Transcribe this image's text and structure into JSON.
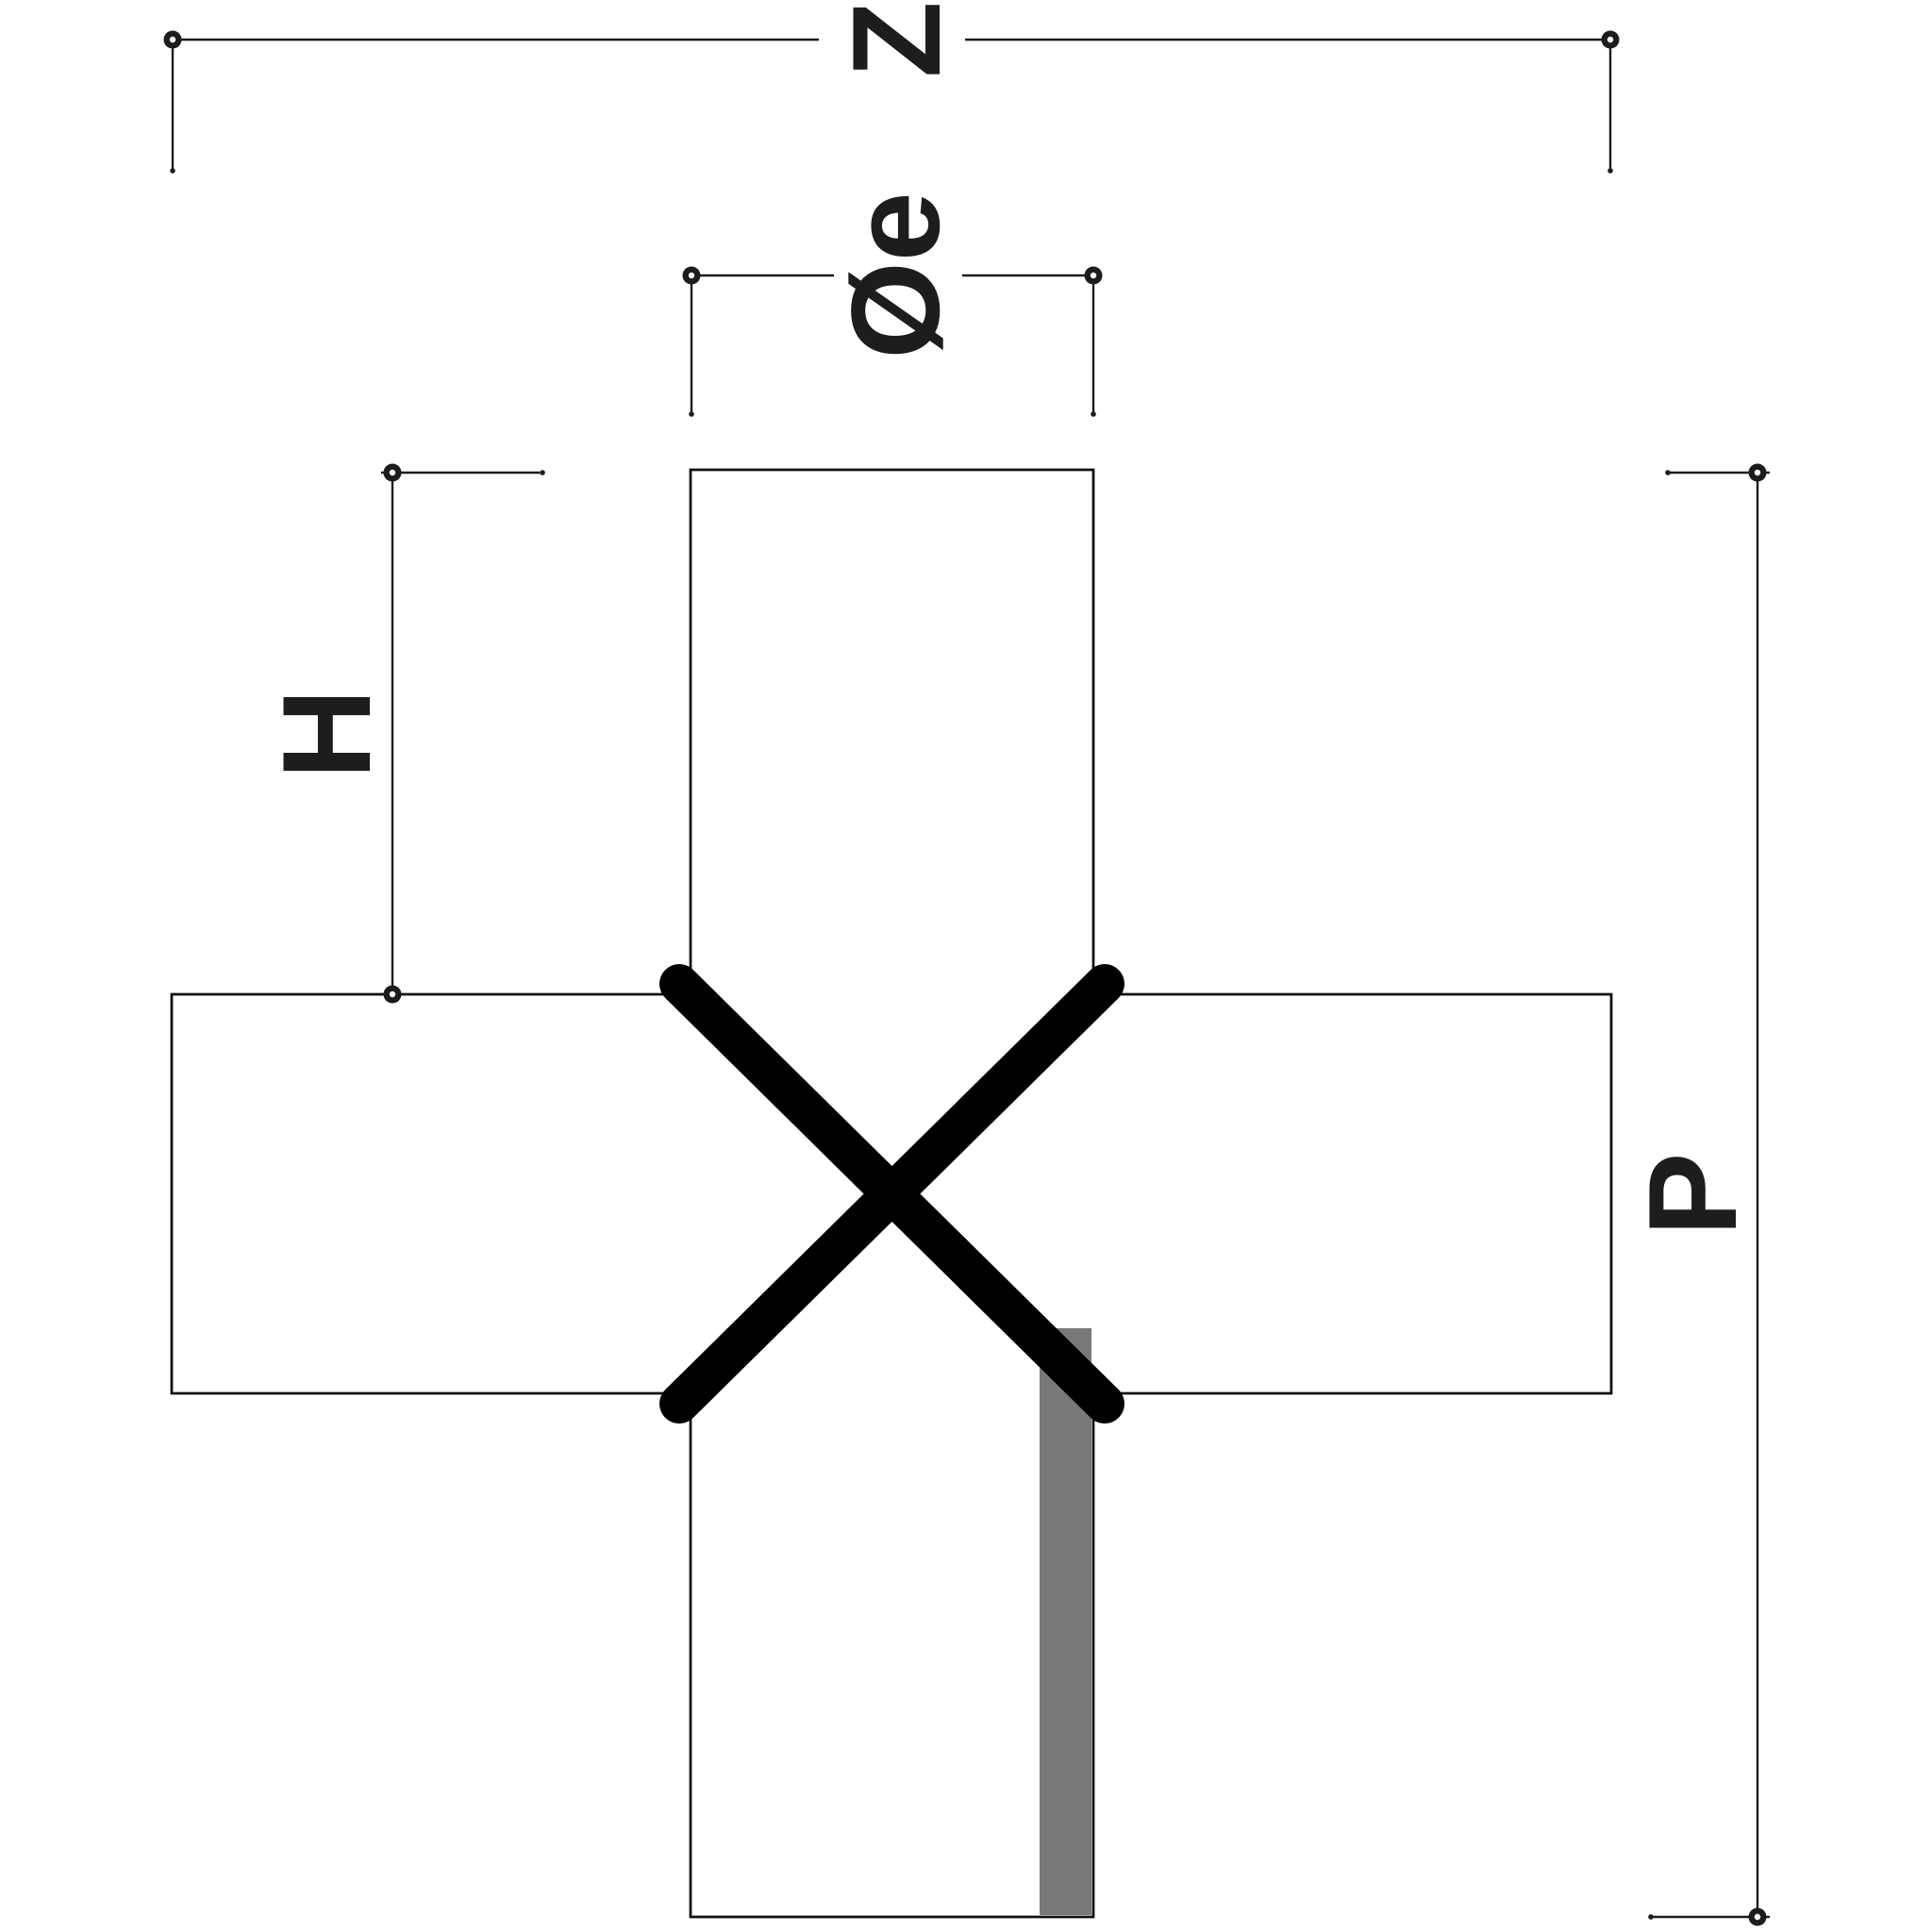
{
  "drawing": {
    "dimension_labels": {
      "top_width": "Z",
      "branch_diameter": "Øe",
      "branch_height": "H",
      "overall_height": "P"
    }
  },
  "colors": {
    "line": "#1c1c1c",
    "outline": "#111111",
    "x_mark": "#000000",
    "strip_gray": "#787878",
    "background": "#ffffff",
    "label": "#1d1d1d"
  }
}
